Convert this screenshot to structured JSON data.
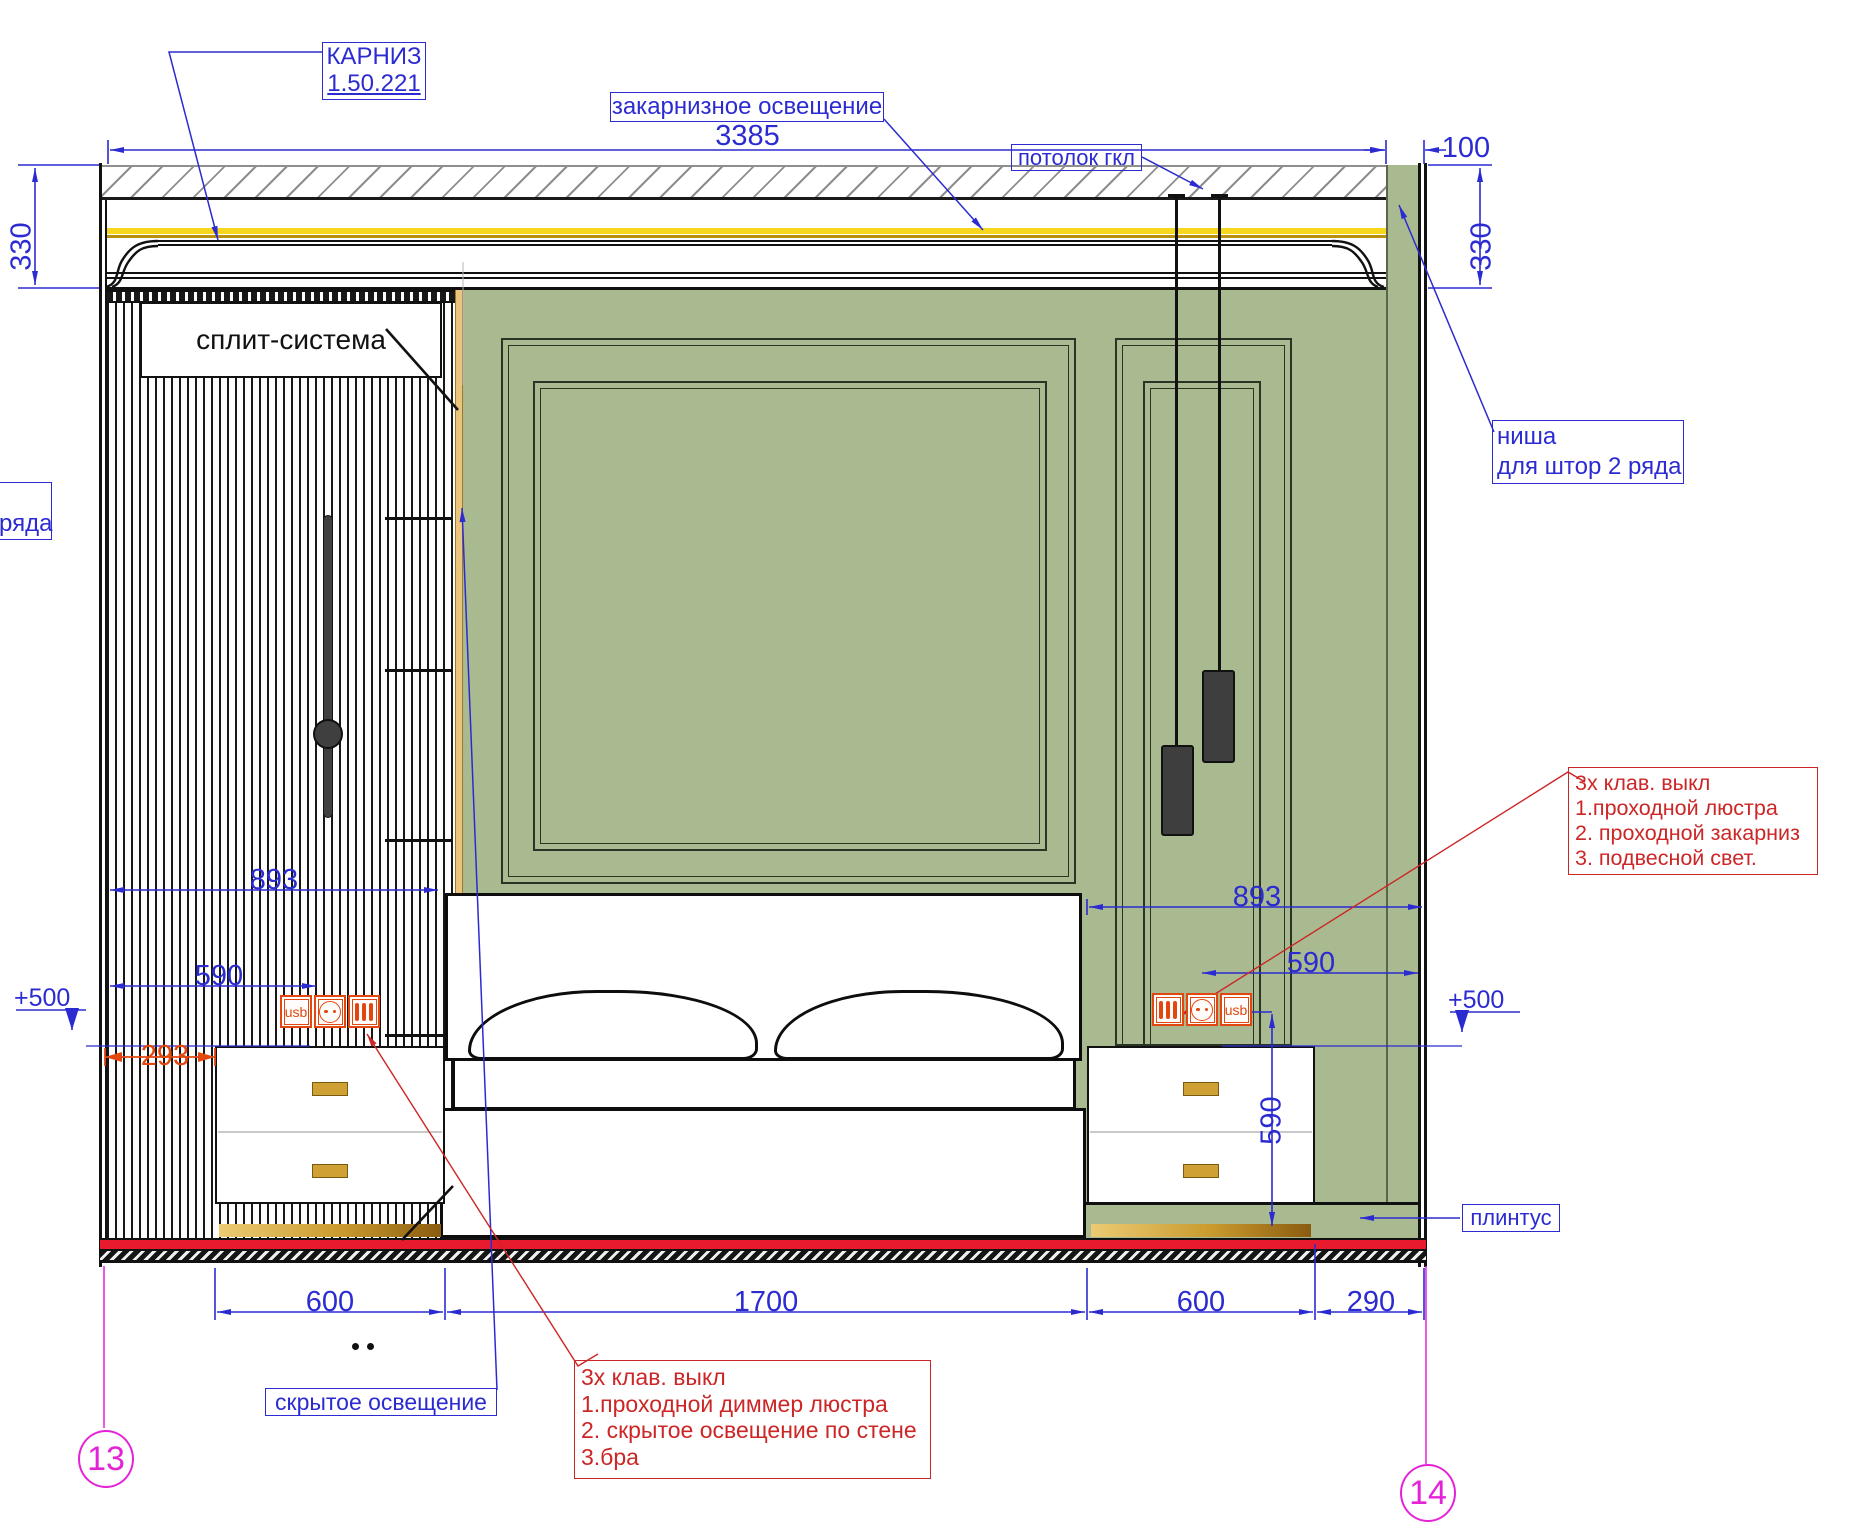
{
  "labels": {
    "cornice_title": "КАРНИЗ",
    "cornice_ref": "1.50.221",
    "cove_light": "закарнизное освещение",
    "ceiling": "потолок гкл",
    "niche_line1": "ниша",
    "niche_line2": "для штор 2 ряда",
    "split_system": "сплит-система",
    "rows_cut": "ряда",
    "hidden_light": "скрытое  освещение",
    "plinth": "плинтус"
  },
  "dimensions": {
    "total": "3385",
    "niche": "100",
    "height_left": "330",
    "height_right": "330",
    "left_893": "893",
    "right_893": "893",
    "left_590": "590",
    "right_590": "590",
    "vertical_590": "590",
    "offset_293": "293",
    "level_left": "+500",
    "level_right": "+500",
    "nightstand_left": "600",
    "bed": "1700",
    "nightstand_right": "600",
    "right_gap": "290"
  },
  "notes": {
    "left": {
      "lines": [
        "3х клав. выкл",
        "1.проходной диммер люстра",
        "2. скрытое освещение по стене",
        "3.бра"
      ]
    },
    "right": {
      "lines": [
        "3х клав. выкл",
        "1.проходной  люстра",
        "2. проходной закарниз",
        "3. подвесной свет."
      ]
    }
  },
  "sockets": {
    "usb": "usb"
  },
  "markers": {
    "left": "13",
    "right": "14"
  },
  "colors": {
    "annotation_blue": "#2b2bd1",
    "annotation_red": "#cc2626",
    "dim_orange": "#e2470f",
    "marker_magenta": "#e423d9",
    "wall_green": "#a9ba90",
    "led_yellow": "#f6d71e",
    "floor_red": "#e81a2e",
    "brass": "#c9992e"
  }
}
